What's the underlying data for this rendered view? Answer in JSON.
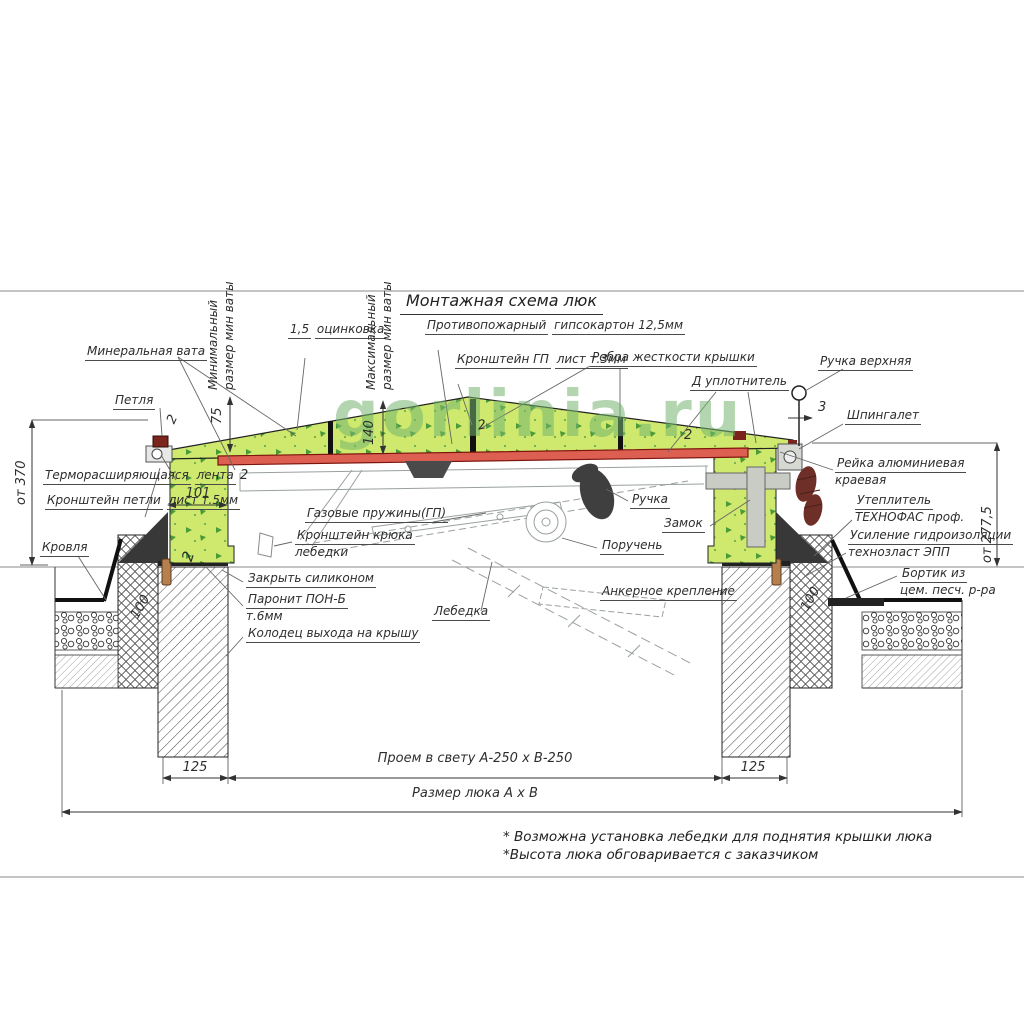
{
  "title": "Монтажная схема люк",
  "watermark": "gorlinia.ru",
  "colors": {
    "wool_green": "#cfe96e",
    "speckle_green": "#4a9b38",
    "sheet_red": "#dd5f52",
    "sheet_red_dark": "#7c150c",
    "hinge_red": "#7a241b",
    "handle_brown": "#6e2f28",
    "metal_gray": "#c9ccc5",
    "watermark_green": "#74b470"
  },
  "labels": {
    "mineral_wool": {
      "l1": "Минеральная вата"
    },
    "min_size": {
      "l1": "Минимальный",
      "l2": "размер мин ваты"
    },
    "zinc": {
      "l1": "1,5",
      "l2": "оцинковка"
    },
    "max_size": {
      "l1": "Максимальный",
      "l2": "размер мин ваты"
    },
    "fireproof": {
      "l1": "Противопожарный",
      "l2": "гипсокартон 12,5мм"
    },
    "gp_bracket": {
      "l1": "Кронштейн ГП",
      "l2": "лист т.3мм"
    },
    "ribs": {
      "l1": "Ребра жесткости крышки"
    },
    "seal": {
      "l1": "Д уплотнитель"
    },
    "handle_top": {
      "l1": "Ручка верхняя"
    },
    "shpingalet": {
      "l1": "Шпингалет"
    },
    "hinge": {
      "l1": "Петля"
    },
    "thermo": {
      "l1": "Терморасширяющаяся",
      "l2": "лента"
    },
    "hinge_bracket": {
      "l1": "Кронштейн петли",
      "l2": "лист т.5мм"
    },
    "roof": {
      "l1": "Кровля"
    },
    "rail": {
      "l1": "Рейка алюминиевая",
      "l2": "краевая"
    },
    "insulation": {
      "l1": "Утеплитель",
      "l2": "ТЕХНОФАС проф."
    },
    "waterproof": {
      "l1": "Усиление гидроизоляции",
      "l2": "технозласт ЭПП"
    },
    "curb": {
      "l1": "Бортик из",
      "l2": "цем. песч. р-ра"
    },
    "gas_springs": {
      "l1": "Газовые пружины(ГП)"
    },
    "winch_bracket": {
      "l1": "Кронштейн крюка",
      "l2": "лебедки"
    },
    "handle": {
      "l1": "Ручка"
    },
    "lock": {
      "l1": "Замок"
    },
    "handrail": {
      "l1": "Поручень"
    },
    "winch": {
      "l1": "Лебедка"
    },
    "anchor": {
      "l1": "Анкерное крепление"
    },
    "silicone": {
      "l1": "Закрыть силиконом"
    },
    "paronite": {
      "l1": "Паронит ПОН-Б",
      "l2": "т.6мм"
    },
    "well": {
      "l1": "Колодец выхода на крышу"
    }
  },
  "dimensions": {
    "from_roof_left": "от 370",
    "from_roof_right": "от 277,5",
    "wool_min": "75",
    "wool_max": "140",
    "curb_width": "101",
    "wall_100_left": "100",
    "wall_100_right": "100",
    "gap_3": "3",
    "t2_hinge": "2",
    "t2_frame": "2",
    "t2_curb": "2",
    "t2_center": "2",
    "t2_right": "2",
    "side_left": "125",
    "side_right": "125",
    "opening": "Проем в свету А-250 х В-250",
    "hatch_size": "Размер люка А х В"
  },
  "notes": {
    "n1": "* Возможна установка лебедки для поднятия крышки люка",
    "n2": "*Высота люка обговаривается с заказчиком"
  }
}
